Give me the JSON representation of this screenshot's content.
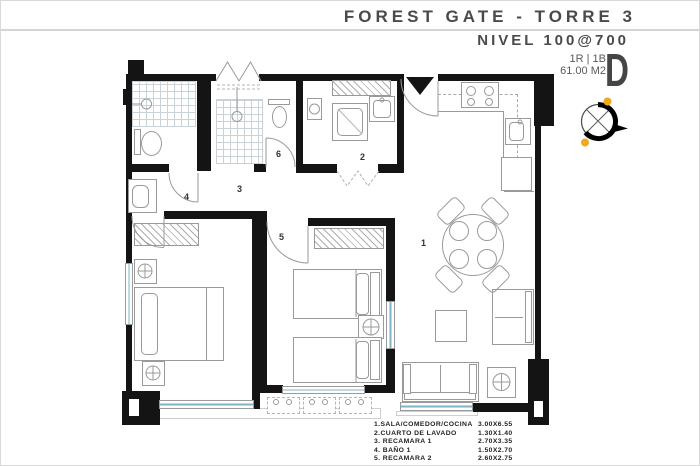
{
  "header": {
    "title": "FOREST GATE - TORRE 3",
    "level": "NIVEL 100@700",
    "unit_type": "1R | 1B",
    "unit_area": "61.00 M2",
    "unit_letter": "D"
  },
  "plan": {
    "room_labels": [
      {
        "id": "1"
      },
      {
        "id": "2"
      },
      {
        "id": "3"
      },
      {
        "id": "4"
      },
      {
        "id": "5"
      },
      {
        "id": "6"
      }
    ],
    "accent_colors": {
      "walls": "#141414",
      "glazing": "#7fb3c6",
      "compass_dots": "#f2a71e"
    }
  },
  "legend": {
    "rows": [
      {
        "name": "1.SALA/COMEDOR/COCINA",
        "dims": "3.00X6.55"
      },
      {
        "name": "2.CUARTO DE LAVADO",
        "dims": "1.30X1.40"
      },
      {
        "name": "3. RECAMARA 1",
        "dims": "2.70X3.35"
      },
      {
        "name": "4. BAÑO 1",
        "dims": "1.50X2.70"
      },
      {
        "name": "5. RECAMARA 2",
        "dims": "2.60X2.75"
      }
    ]
  }
}
